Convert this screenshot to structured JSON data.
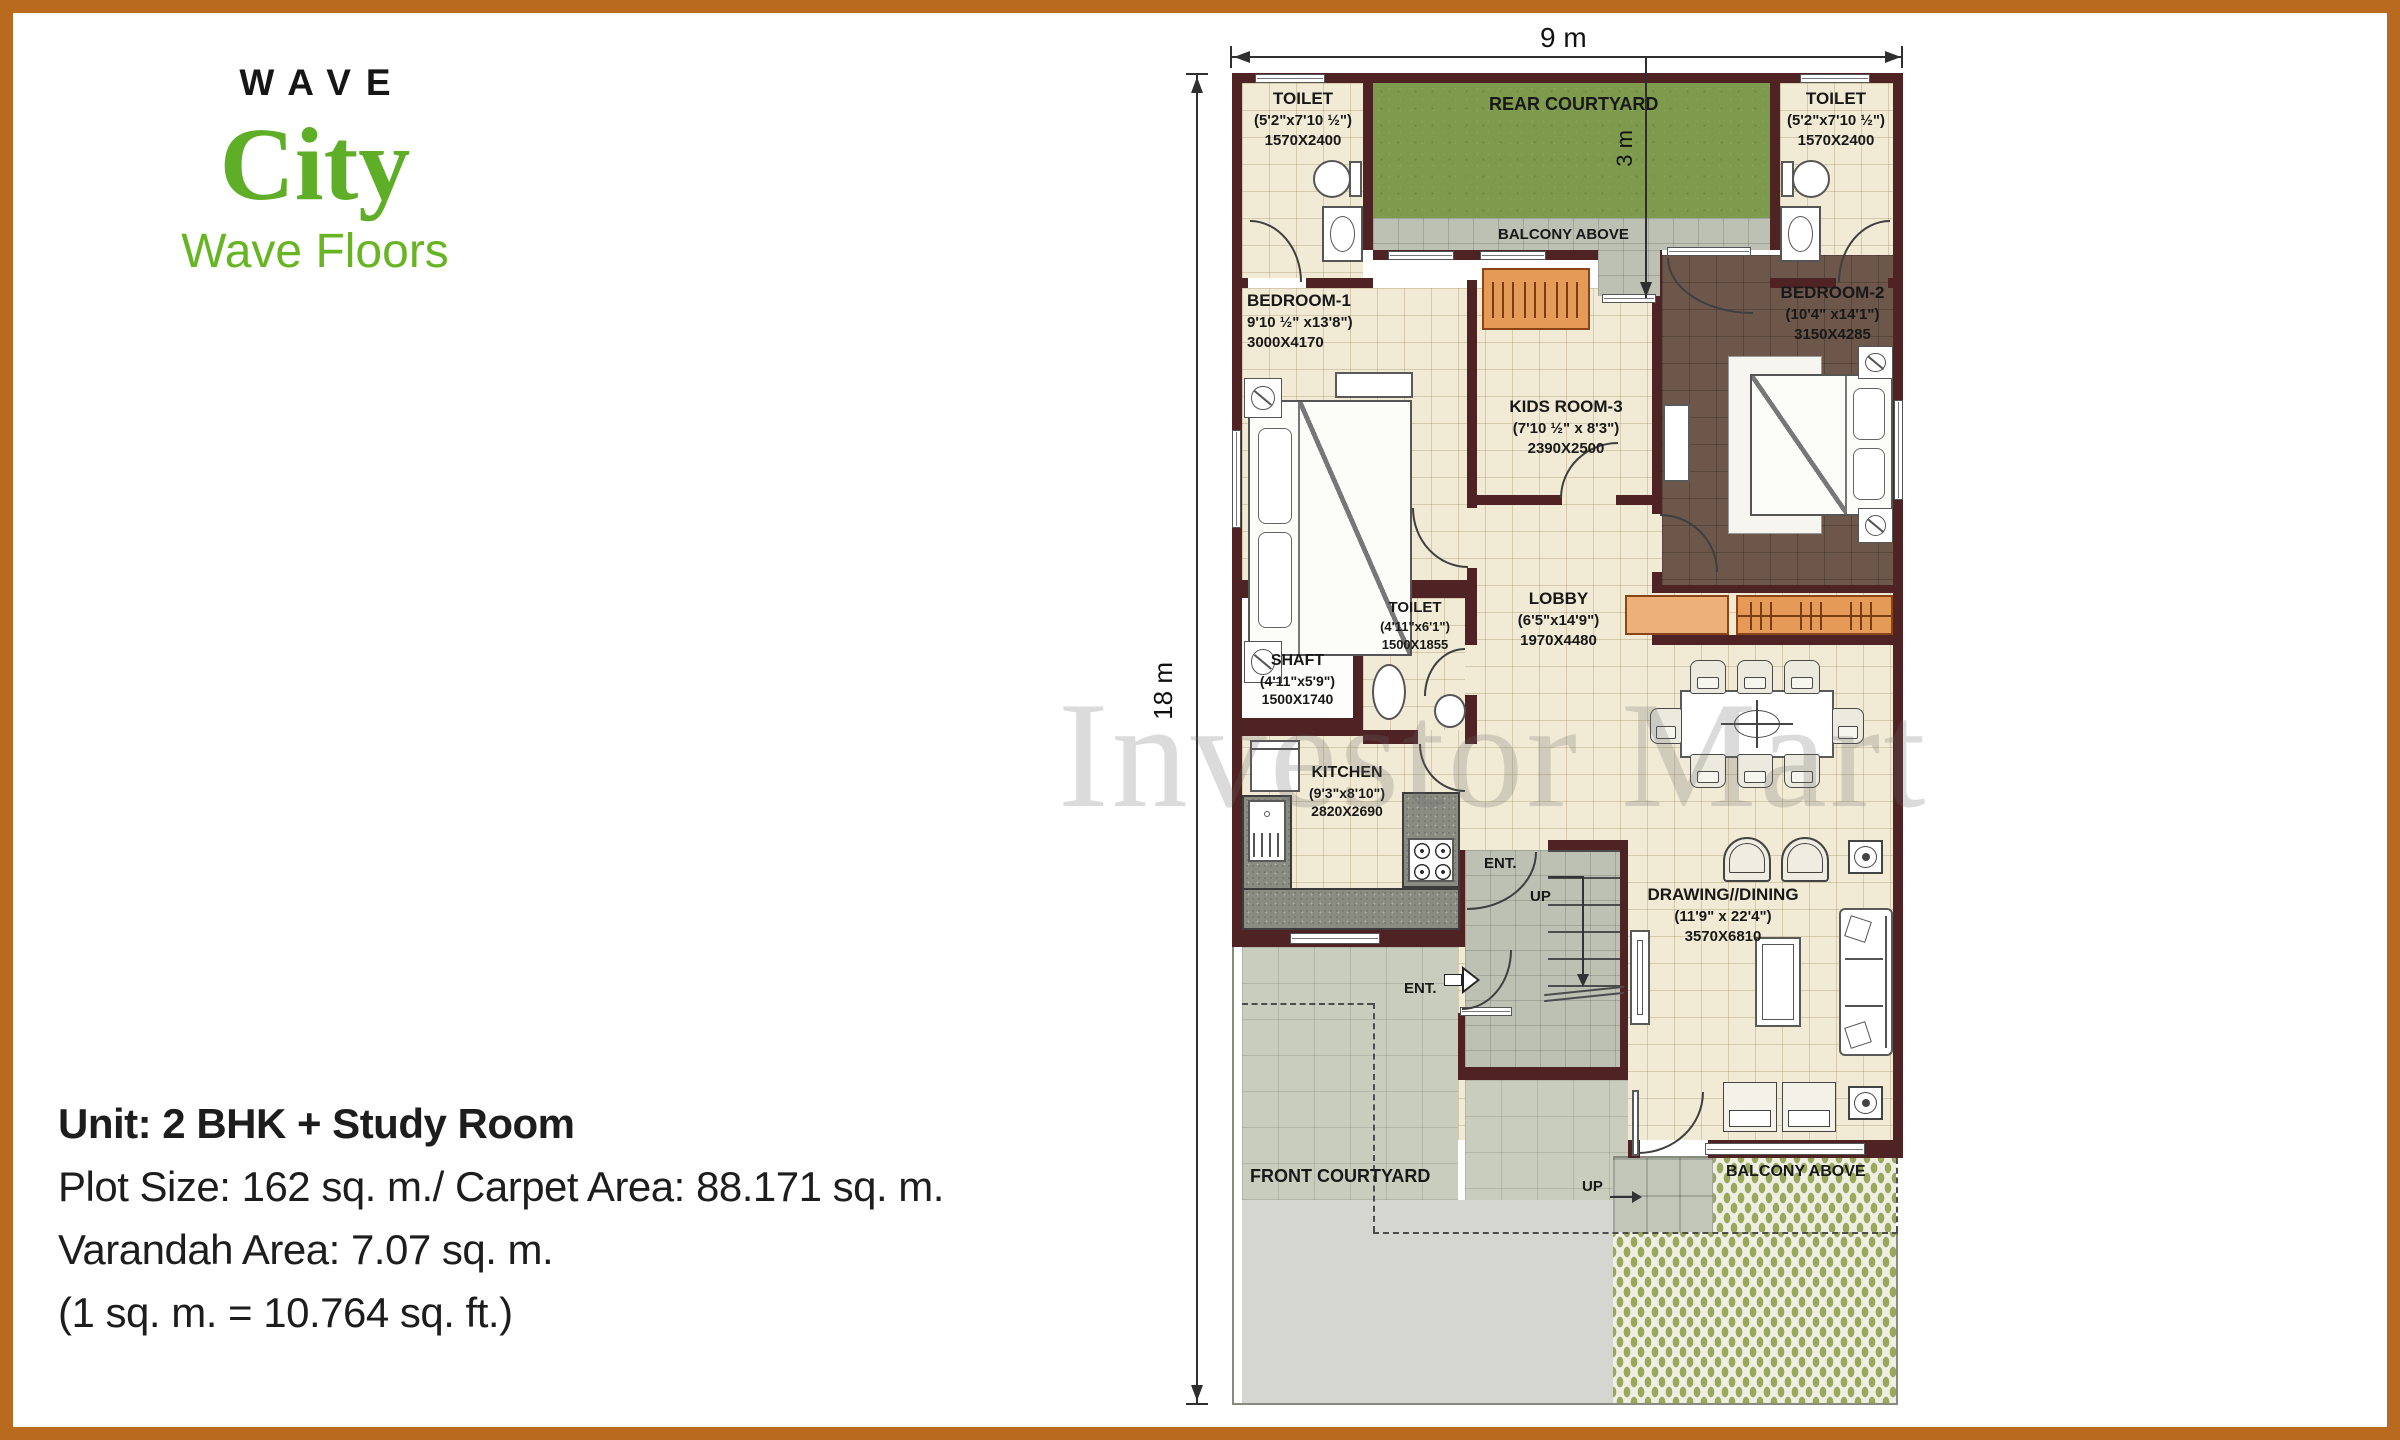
{
  "brand": {
    "wave": "WAVE",
    "city": "City",
    "tagline": "Wave Floors"
  },
  "unit_details": {
    "line1": "Unit: 2 BHK + Study Room",
    "line2": "Plot Size: 162 sq. m./ Carpet Area: 88.171 sq. m.",
    "line3": "Varandah Area: 7.07 sq. m.",
    "line4": "(1 sq. m. = 10.764 sq. ft.)"
  },
  "watermark": "Investor Mart",
  "dimensions": {
    "plot_width": "9 m",
    "plot_depth": "18 m",
    "rear_courtyard_depth": "3 m"
  },
  "rooms": {
    "toilet_top_left": {
      "name": "TOILET",
      "size": "(5'2\"x7'10 ½\")",
      "mm": "1570X2400"
    },
    "toilet_top_right": {
      "name": "TOILET",
      "size": "(5'2\"x7'10 ½\")",
      "mm": "1570X2400"
    },
    "rear_courtyard": {
      "name": "REAR COURTYARD"
    },
    "balcony_above_top": {
      "name": "BALCONY ABOVE"
    },
    "bedroom_1": {
      "name": "BEDROOM-1",
      "size": "9'10 ½\" x13'8\")",
      "mm": "3000X4170"
    },
    "bedroom_2": {
      "name": "BEDROOM-2",
      "size": "(10'4\" x14'1\")",
      "mm": "3150X4285"
    },
    "kids_room": {
      "name": "KIDS ROOM-3",
      "size": "(7'10 ½\" x 8'3\")",
      "mm": "2390X2500"
    },
    "shaft": {
      "name": "SHAFT",
      "size": "(4'11\"x5'9\")",
      "mm": "1500X1740"
    },
    "toilet_mid": {
      "name": "TOILET",
      "size": "(4'11\"x6'1\")",
      "mm": "1500X1855"
    },
    "lobby": {
      "name": "LOBBY",
      "size": "(6'5\"x14'9\")",
      "mm": "1970X4480"
    },
    "kitchen": {
      "name": "KITCHEN",
      "size": "(9'3\"x8'10\")",
      "mm": "2820X2690"
    },
    "drawing_dining": {
      "name": "DRAWING//DINING",
      "size": "(11'9\" x 22'4\")",
      "mm": "3570X6810"
    },
    "front_courtyard": {
      "name": "FRONT COURTYARD"
    },
    "balcony_above_bottom": {
      "name": "BALCONY ABOVE"
    }
  },
  "markers": {
    "ent_lobby": "ENT.",
    "ent_main": "ENT.",
    "up_stairs": "UP",
    "up_plot": "UP"
  }
}
